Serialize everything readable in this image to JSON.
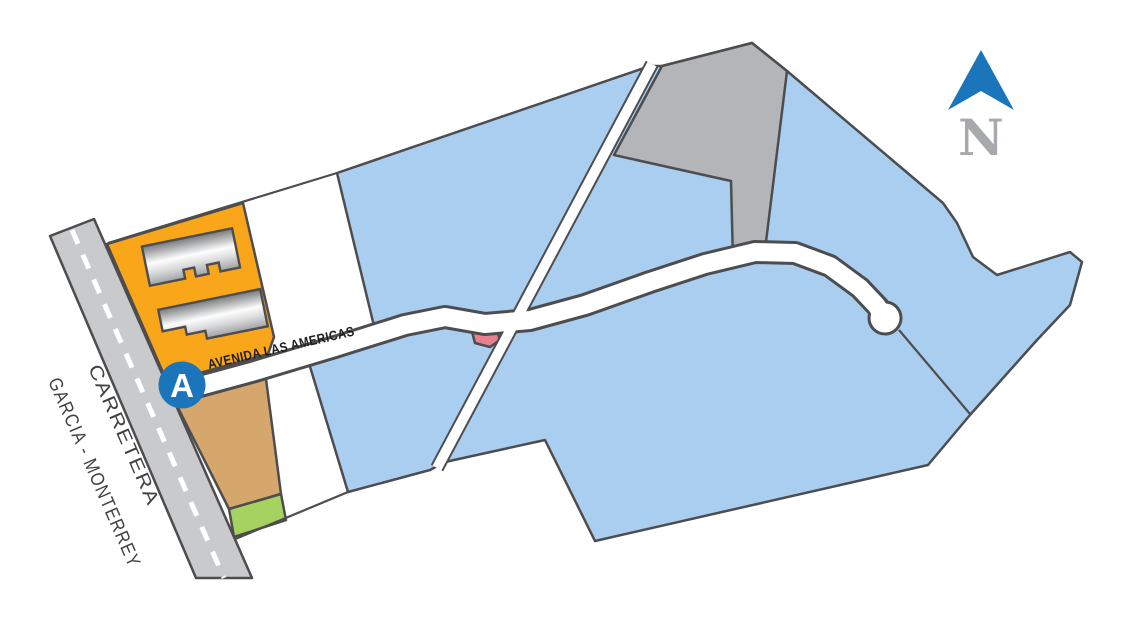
{
  "map": {
    "carretera_label": {
      "line1": "CARRETERA",
      "line2": "GARCIA - MONTERREY"
    },
    "avenue_label": "AVENIDA LAS AMERICAS",
    "marker": {
      "letter": "A"
    },
    "compass": {
      "letter": "N"
    },
    "colors": {
      "parcel_blue": "#A9CEEF",
      "parcel_gray": "#B3B5B8",
      "parcel_orange": "#F9A61B",
      "parcel_tan": "#D6A76C",
      "parcel_green": "#A6D35F",
      "parcel_red": "#E8818F",
      "road_gray": "#C9CACC",
      "road_white": "#FFFFFF",
      "outline_dark": "#4D4D4F",
      "marker_blue": "#1B75BB",
      "compass_arrow_blue": "#1B75BB",
      "compass_letter_gray": "#A7A9AC"
    }
  }
}
